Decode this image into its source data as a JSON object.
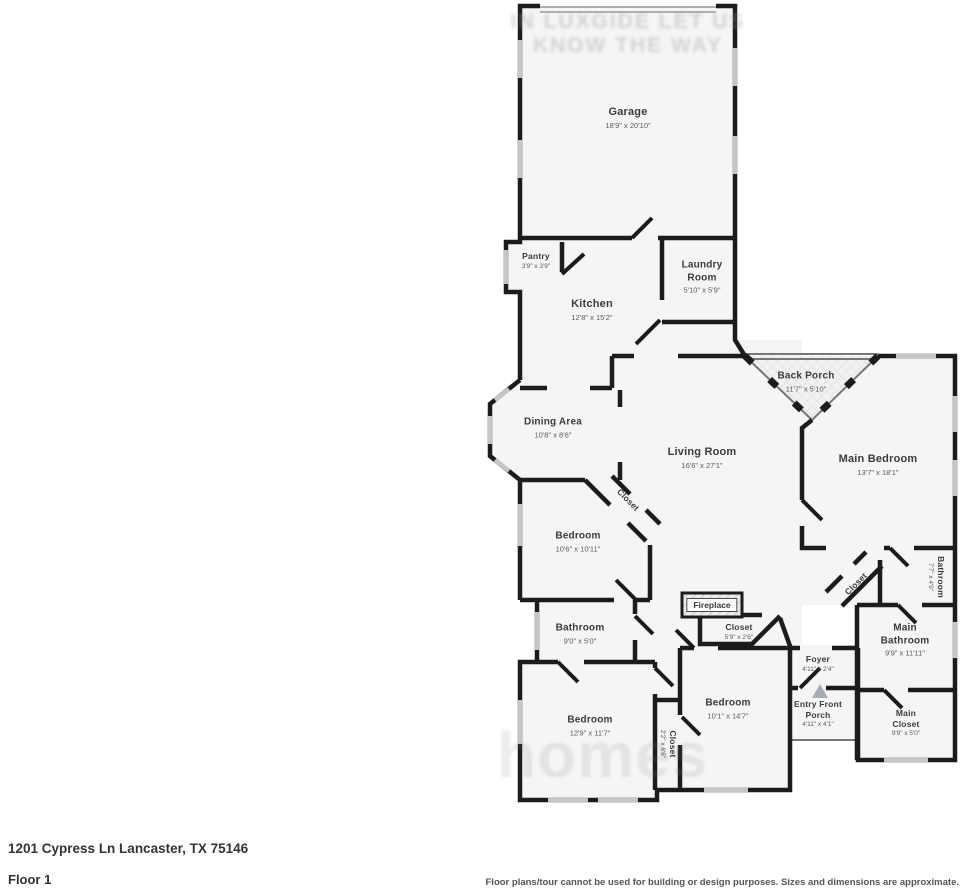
{
  "watermark": {
    "top_line1": "IN LUXGIDE LET US",
    "top_line2": "KNOW THE WAY",
    "bottom": "homes"
  },
  "rooms": [
    {
      "name": "Garage",
      "dims": "18'9\" x 20'10\""
    },
    {
      "name": "Pantry",
      "dims": "3'9\" x 3'9\""
    },
    {
      "name": "Laundry Room",
      "dims": "5'10\" x 5'9\""
    },
    {
      "name": "Kitchen",
      "dims": "12'8\" x 15'2\""
    },
    {
      "name": "Back Porch",
      "dims": "11'7\" x 5'10\""
    },
    {
      "name": "Dining Area",
      "dims": "10'8\" x 8'6\""
    },
    {
      "name": "Living Room",
      "dims": "16'6\" x 27'1\""
    },
    {
      "name": "Main Bedroom",
      "dims": "13'7\" x 18'1\""
    },
    {
      "name": "Closet",
      "dims": ""
    },
    {
      "name": "Bedroom",
      "dims": "10'6\" x 10'11\""
    },
    {
      "name": "Bathroom",
      "dims": "9'0\" x 5'0\""
    },
    {
      "name": "Fireplace",
      "dims": ""
    },
    {
      "name": "Closet",
      "dims": "5'9\" x 2'6\""
    },
    {
      "name": "Bathroom",
      "dims": "7'7\" x 4'9\""
    },
    {
      "name": "Closet",
      "dims": ""
    },
    {
      "name": "Main Bathroom",
      "dims": "9'9\" x 11'11\""
    },
    {
      "name": "Foyer",
      "dims": "4'11\" x 2'4\""
    },
    {
      "name": "Entry Front Porch",
      "dims": "4'11\" x 4'1\""
    },
    {
      "name": "Bedroom",
      "dims": "12'9\" x 11'7\""
    },
    {
      "name": "Bedroom",
      "dims": "10'1\" x 14'7\""
    },
    {
      "name": "Closet",
      "dims": "2'2\" x 6'6\""
    },
    {
      "name": "Main Closet",
      "dims": "9'9\" x 5'0\""
    }
  ],
  "footer": {
    "address": "1201 Cypress Ln Lancaster, TX 75146",
    "floor": "Floor 1",
    "disclaimer": "Floor plans/tour cannot be used for building or design purposes. Sizes and dimensions are approximate."
  },
  "colors": {
    "wall": "#1c1c1c",
    "floor": "#f5f5f5",
    "window": "#c6c6c6",
    "label_text": "#3b3b3b"
  }
}
